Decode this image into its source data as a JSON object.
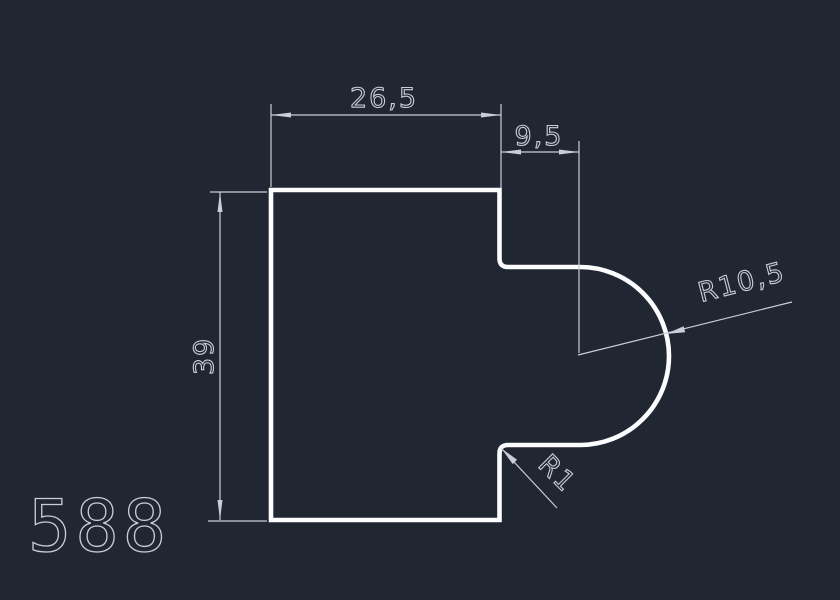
{
  "drawing": {
    "part_label": "588",
    "dims": {
      "top_width": "26,5",
      "step_width": "9,5",
      "height": "39",
      "big_radius": "R10,5",
      "small_radius": "R1"
    },
    "colors": {
      "background": "#212633",
      "profile": "#fbfcfd",
      "dimension": "#c9ced6"
    }
  }
}
